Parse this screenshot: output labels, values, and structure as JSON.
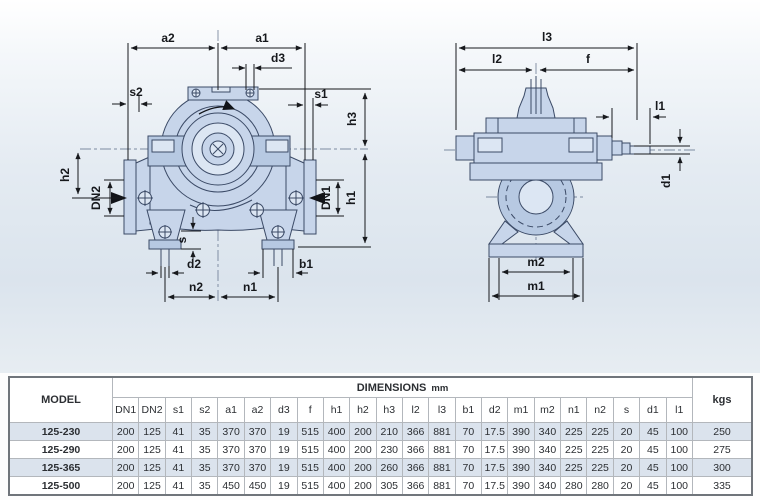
{
  "diagrams": {
    "front_view": {
      "labels": {
        "a2": "a2",
        "a1": "a1",
        "d3": "d3",
        "s2": "s2",
        "s1": "s1",
        "h3": "h3",
        "h2": "h2",
        "dn2": "DN2",
        "dn1": "DN1",
        "h1": "h1",
        "s": "s",
        "d2": "d2",
        "b1": "b1",
        "n2": "n2",
        "n1": "n1"
      }
    },
    "side_view": {
      "labels": {
        "l3": "l3",
        "l2": "l2",
        "f": "f",
        "l1": "l1",
        "d1": "d1",
        "m2": "m2",
        "m1": "m1"
      }
    }
  },
  "table": {
    "model_header": "MODEL",
    "dimensions_header": "DIMENSIONS",
    "unit": "mm",
    "weight_header": "kgs",
    "columns": [
      "DN1",
      "DN2",
      "s1",
      "s2",
      "a1",
      "a2",
      "d3",
      "f",
      "h1",
      "h2",
      "h3",
      "l2",
      "l3",
      "b1",
      "d2",
      "m1",
      "m2",
      "n1",
      "n2",
      "s",
      "d1",
      "l1"
    ],
    "rows": [
      {
        "model": "125-230",
        "values": [
          "200",
          "125",
          "41",
          "35",
          "370",
          "370",
          "19",
          "515",
          "400",
          "200",
          "210",
          "366",
          "881",
          "70",
          "17.5",
          "390",
          "340",
          "225",
          "225",
          "20",
          "45",
          "100"
        ],
        "kgs": "250"
      },
      {
        "model": "125-290",
        "values": [
          "200",
          "125",
          "41",
          "35",
          "370",
          "370",
          "19",
          "515",
          "400",
          "200",
          "230",
          "366",
          "881",
          "70",
          "17.5",
          "390",
          "340",
          "225",
          "225",
          "20",
          "45",
          "100"
        ],
        "kgs": "275"
      },
      {
        "model": "125-365",
        "values": [
          "200",
          "125",
          "41",
          "35",
          "370",
          "370",
          "19",
          "515",
          "400",
          "200",
          "260",
          "366",
          "881",
          "70",
          "17.5",
          "390",
          "340",
          "225",
          "225",
          "20",
          "45",
          "100"
        ],
        "kgs": "300"
      },
      {
        "model": "125-500",
        "values": [
          "200",
          "125",
          "41",
          "35",
          "450",
          "450",
          "19",
          "515",
          "400",
          "200",
          "305",
          "366",
          "881",
          "70",
          "17.5",
          "390",
          "340",
          "280",
          "280",
          "20",
          "45",
          "100"
        ],
        "kgs": "335"
      }
    ]
  },
  "colors": {
    "body_fill": "#c7d5ea",
    "body_fill_dark": "#b7c9e2",
    "body_fill_light": "#dce6f3",
    "outline": "#3b4a66",
    "dimension": "#17191d",
    "row_shade": "#dbe3ed",
    "diagram_bg": "#dbe4ed"
  }
}
